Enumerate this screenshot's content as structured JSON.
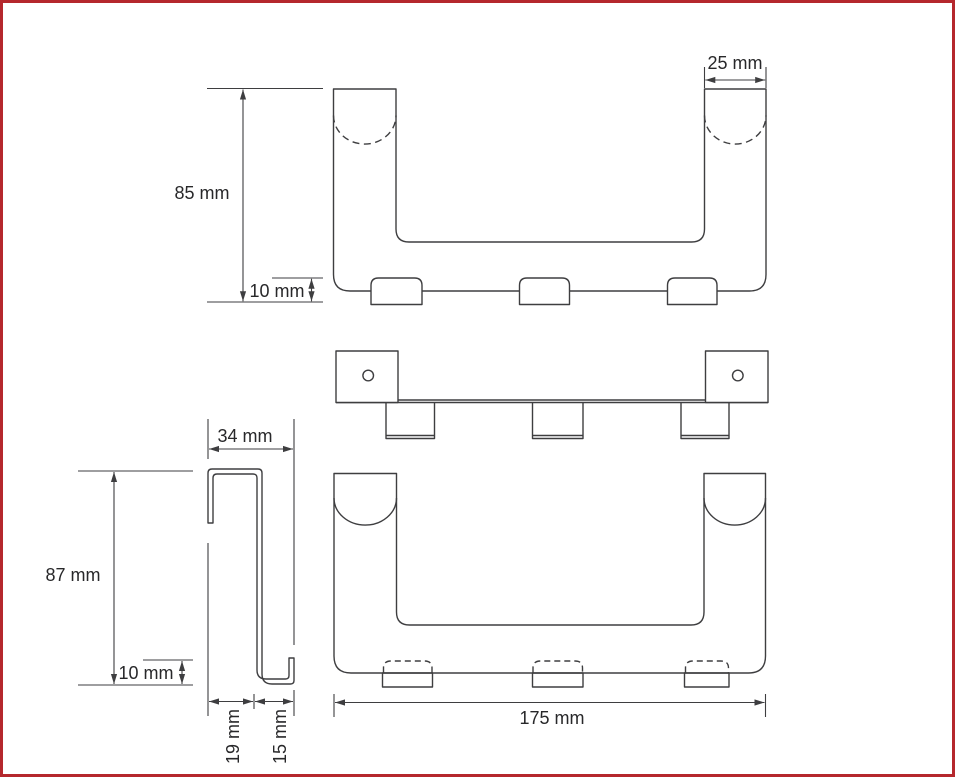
{
  "drawing": {
    "colors": {
      "border": "#b5282d",
      "line": "#3e3e40",
      "text": "#28282a"
    },
    "views": {
      "front": {
        "height_label": "85 mm",
        "hook_height_label": "10 mm",
        "hanger_width_label": "25 mm"
      },
      "back": {
        "overall_width_label": "175 mm"
      },
      "side": {
        "overall_depth_label": "34 mm",
        "height_label": "87 mm",
        "hook_lip_label": "10 mm",
        "inner_depth_label": "19 mm",
        "hook_depth_label": "15 mm"
      }
    }
  }
}
